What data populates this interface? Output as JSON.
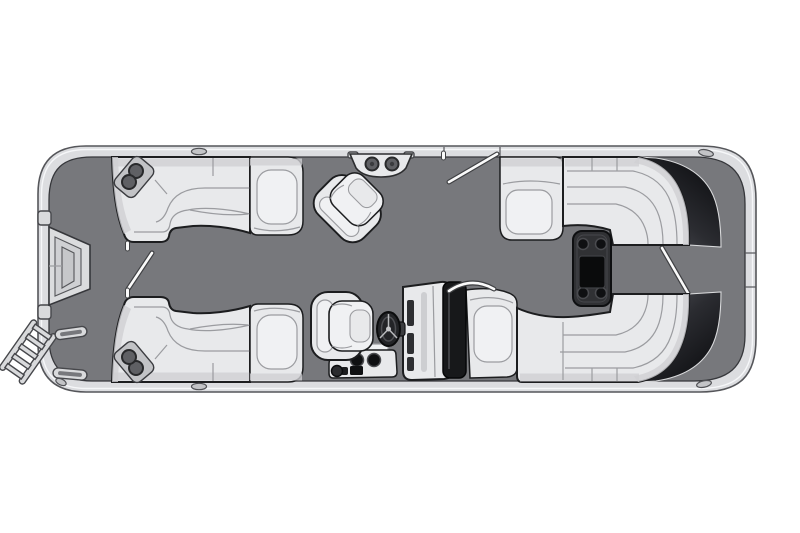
{
  "canvas": {
    "width": 800,
    "height": 533,
    "background": "#ffffff"
  },
  "colors": {
    "canvas_bg": "#ffffff",
    "deck": "#77787c",
    "deck_outline": "#36373b",
    "hull_rim": "#dcdde0",
    "hull_outline": "#55565a",
    "hull_highlight": "#f7f8fa",
    "seat_base": "#e8e9eb",
    "seat_light": "#f0f1f3",
    "seat_shade": "#cfd0d3",
    "seat_seam": "#9b9ca0",
    "seat_outline": "#1c1d1f",
    "metal_gray": "#d9dadc",
    "metal_outline": "#46474b",
    "band_inner": "#54555c",
    "band_mid": "#2b2c31",
    "band_outer": "#0e0f12",
    "windshield": "#17181a",
    "table_dark": "#303134",
    "table_edge": "#0e0f11",
    "cup_dark": "#0f1012",
    "cup_gray": "#5f6064",
    "rail_white": "#fafafa",
    "rail_outline": "#3f4043",
    "gate_light": "#dbdcde"
  },
  "parts": [
    {
      "name": "hull",
      "label": "pontoon hull with rub rail"
    },
    {
      "name": "deck-floor",
      "label": "open deck floor"
    },
    {
      "name": "bow-boarding-gate",
      "label": "bow boarding gate"
    },
    {
      "name": "boarding-ladder",
      "label": "bow boarding ladder"
    },
    {
      "name": "grab-handle",
      "label": "boarding grab handles"
    },
    {
      "name": "port-bow-lounge",
      "label": "port bow L-lounge with armrest"
    },
    {
      "name": "starboard-bow-lounge",
      "label": "starboard bow L-lounge with armrest"
    },
    {
      "name": "cupholder",
      "label": "corner cupholders"
    },
    {
      "name": "bow-aisle-grab-rail",
      "label": "bow aisle grab rail"
    },
    {
      "name": "port-gate-grab-rail",
      "label": "port side gate grab rail"
    },
    {
      "name": "rail-cocktail-table",
      "label": "rail-mount cocktail table with 2 cupholders"
    },
    {
      "name": "port-swivel-chair",
      "label": "port swivel captain chair"
    },
    {
      "name": "captain-chair",
      "label": "helm captain chair"
    },
    {
      "name": "helm-console",
      "label": "helm console"
    },
    {
      "name": "windshield",
      "label": "console windshield"
    },
    {
      "name": "steering-wheel",
      "label": "steering wheel"
    },
    {
      "name": "helm-grab-bar",
      "label": "console grab bar"
    },
    {
      "name": "helm-side-console",
      "label": "side console with cupholders"
    },
    {
      "name": "console-fairing",
      "label": "console fairing step"
    },
    {
      "name": "aft-port-lounge",
      "label": "aft port wraparound lounge"
    },
    {
      "name": "aft-starboard-lounge",
      "label": "aft starboard wraparound lounge"
    },
    {
      "name": "sun-backrest",
      "label": "dark curved sun-lounge backrests"
    },
    {
      "name": "stern-table",
      "label": "stern table with 4 cupholders"
    },
    {
      "name": "stern-gate-grab-rail",
      "label": "stern gate grab rail"
    },
    {
      "name": "cleat",
      "label": "mooring cleats"
    }
  ]
}
